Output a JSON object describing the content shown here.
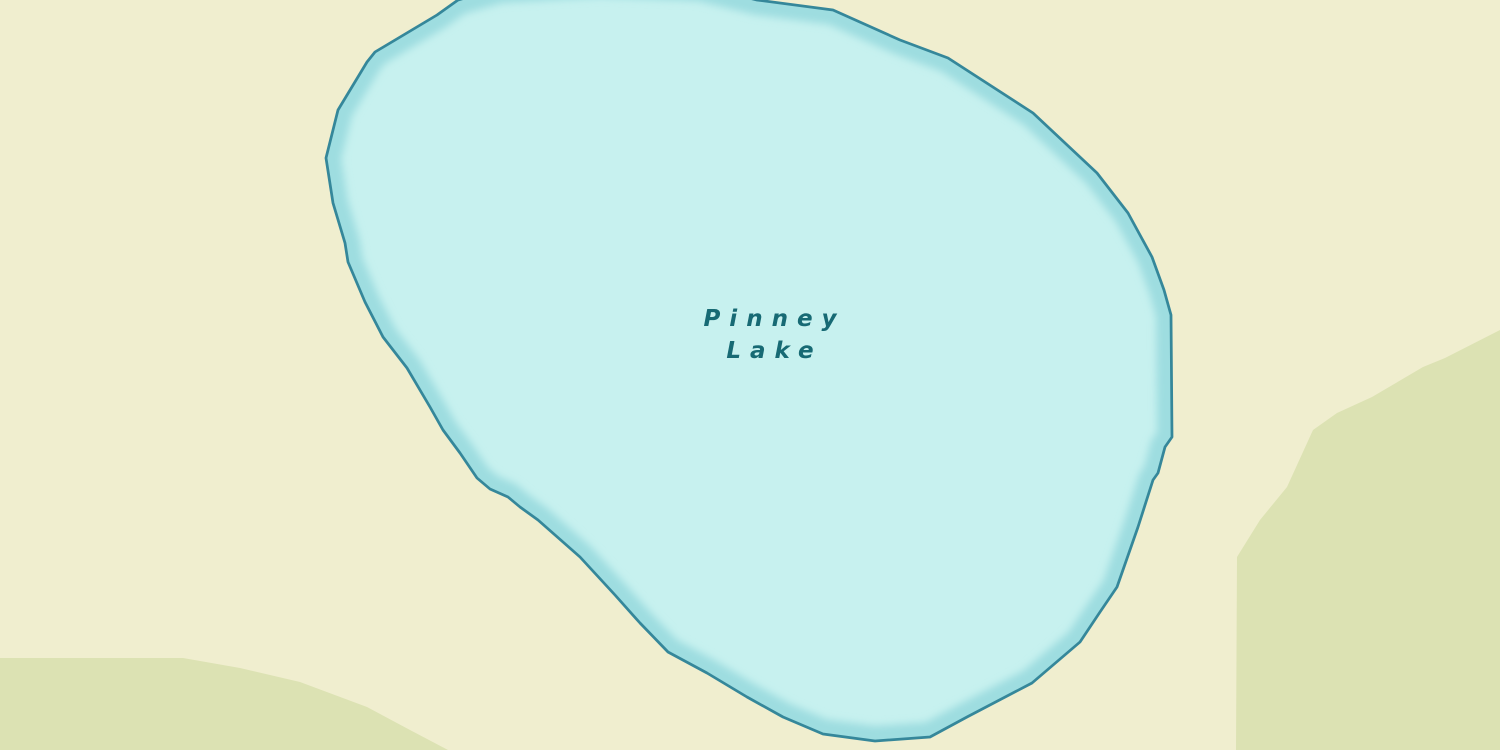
{
  "map": {
    "lake": {
      "name": "Pinney Lake",
      "label_line1": "Pinney",
      "label_line2": "Lake"
    },
    "colors": {
      "land": "#f0eecf",
      "vegetation": "#dce2b3",
      "lake_fill": "#c7f1ef",
      "lake_edge_glow": "#9edde0",
      "lake_outline": "#35879a",
      "lake_label_text": "#176a74"
    }
  }
}
